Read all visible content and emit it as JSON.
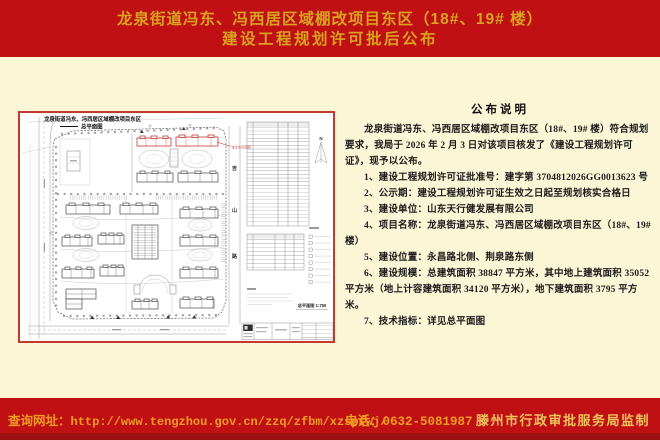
{
  "header": {
    "title_line1": "龙泉街道冯东、冯西居区域棚改项目东区（18#、19# 楼）",
    "title_line2": "建设工程规划许可批后公布"
  },
  "notice": {
    "title": "公布说明",
    "intro": "龙泉街道冯东、冯西居区域棚改项目东区（18#、19# 楼）符合规划要求，我局于 2026 年 2 月 3 日对该项目核发了《建设工程规划许可证》，现予以公布。",
    "items": [
      "1、建设工程规划许可证批准号：建字第 3704812026GG0013623 号",
      "2、公示期：建设工程规划许可证生效之日起至规划核实合格日",
      "3、建设单位：山东天行健发展有限公司",
      "4、项目名称：龙泉街道冯东、冯西居区域棚改项目东区（18#、19# 楼）",
      "5、建设位置：永昌路北侧、荆泉路东侧",
      "6、建设规模：总建筑面积 38847 平方米，其中地上建筑面积 35052 平方米（地上计容建筑面积 34120 平方米），地下建筑面积 3795 平方米。",
      "7、技术指标：详见总平面图"
    ]
  },
  "plan": {
    "title": "龙泉街道冯东、冯西居区域棚改项目东区",
    "subtitle": "总平面图",
    "road_chars": [
      "吉",
      "山",
      "路"
    ],
    "red_note": "本次许可范围",
    "north_label": "N",
    "scale_label": "总平面图 1:750"
  },
  "footer": {
    "url_label": "查询网址：",
    "url": "http://www.tengzhou.gov.cn/zzq/zfbm/xzspfwj/",
    "phone": "电话：0632-5081987",
    "agency": "滕州市行政审批服务局监制"
  },
  "colors": {
    "header_red": "#c01013",
    "bottom_strip_red": "#9c0f10",
    "title_gold": "#d9a21f",
    "panel_cream": "#fbf6d6",
    "footer_orange": "#ef9d20",
    "agency_gold": "#eec45c",
    "plan_frame_red": "#c5382e"
  }
}
